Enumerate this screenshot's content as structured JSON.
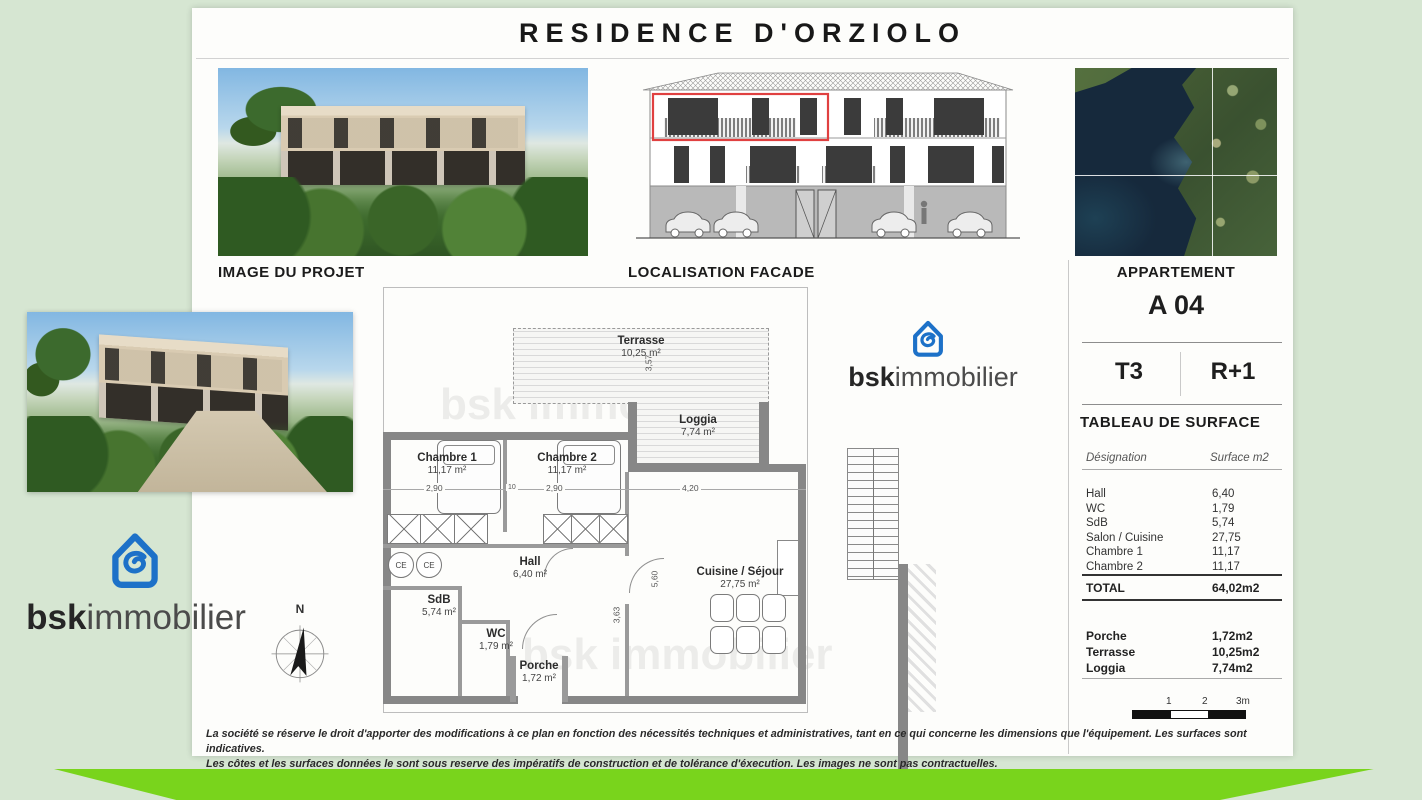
{
  "page": {
    "title": "RESIDENCE D'ORZIOLO",
    "disclaimer1": "La société se réserve le droit d'apporter des modifications à ce plan en fonction des nécessités techniques et administratives, tant en ce qui concerne les dimensions que l'équipement. Les surfaces sont indicatives.",
    "disclaimer2": "Les côtes et les surfaces données le sont sous reserve des impératifs de construction et de tolérance d'éxecution. Les images ne sont pas contractuelles."
  },
  "sections": {
    "project_label": "IMAGE DU PROJET",
    "facade_label": "LOCALISATION FACADE"
  },
  "panel": {
    "header": "APPARTEMENT",
    "code": "A 04",
    "type": "T3",
    "floor": "R+1",
    "surface_title": "TABLEAU DE SURFACE",
    "col_designation": "Désignation",
    "col_surface": "Surface m2",
    "rows": [
      {
        "label": "Hall",
        "value": "6,40"
      },
      {
        "label": "WC",
        "value": "1,79"
      },
      {
        "label": "SdB",
        "value": "5,74"
      },
      {
        "label": "Salon / Cuisine",
        "value": "27,75"
      },
      {
        "label": "Chambre 1",
        "value": "11,17"
      },
      {
        "label": "Chambre 2",
        "value": "11,17"
      }
    ],
    "total_label": "TOTAL",
    "total_value": "64,02m2",
    "extra": [
      {
        "label": "Porche",
        "value": "1,72m2"
      },
      {
        "label": "Terrasse",
        "value": "10,25m2"
      },
      {
        "label": "Loggia",
        "value": "7,74m2"
      }
    ],
    "scale": {
      "t1": "1",
      "t2": "2",
      "t3": "3m"
    }
  },
  "plan": {
    "rooms": {
      "terrasse": {
        "name": "Terrasse",
        "area": "10,25 m²"
      },
      "loggia": {
        "name": "Loggia",
        "area": "7,74 m²"
      },
      "chambre1": {
        "name": "Chambre 1",
        "area": "11,17 m²"
      },
      "chambre2": {
        "name": "Chambre 2",
        "area": "11,17 m²"
      },
      "hall": {
        "name": "Hall",
        "area": "6,40 m²"
      },
      "sdb": {
        "name": "SdB",
        "area": "5,74 m²"
      },
      "wc": {
        "name": "WC",
        "area": "1,79 m²"
      },
      "porche": {
        "name": "Porche",
        "area": "1,72 m²"
      },
      "cuisine": {
        "name": "Cuisine / Séjour",
        "area": "27,75 m²"
      }
    },
    "ce": "CE",
    "dims": {
      "chambre1_w": "2,90",
      "gap": "10",
      "chambre2_w": "2,90",
      "loggia_w": "4,20",
      "terrasse_h": "3,57",
      "sejour_h": "5,60",
      "hall_h": "3,63"
    },
    "compass": "N",
    "watermark": "bsk immobilier"
  },
  "brand": {
    "bold": "bsk",
    "light": "immobilier"
  },
  "colors": {
    "page_bg": "#d6e6d2",
    "banner_green": "#79d41c",
    "logo_blue": "#1d71c8",
    "highlight_red": "#e04040"
  }
}
